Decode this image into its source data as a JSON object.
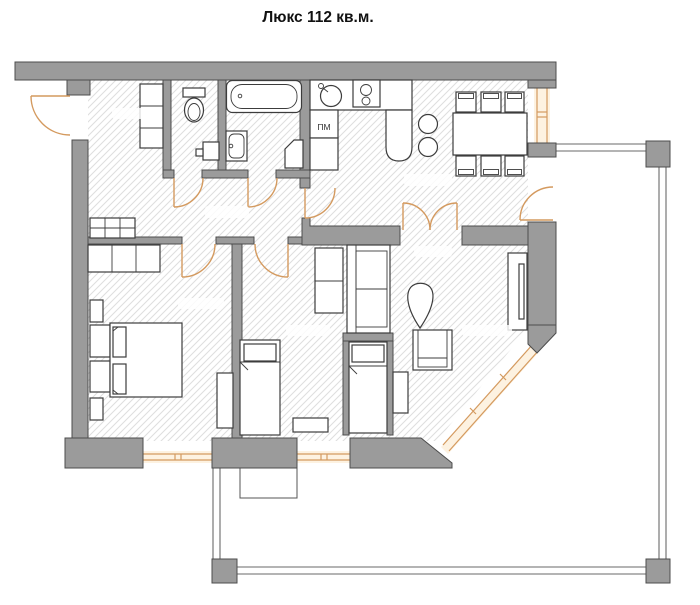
{
  "title": "Люкс 112 кв.м.",
  "plan": {
    "type": "floor-plan",
    "labels": {
      "dishwasher": "ПМ"
    },
    "colors": {
      "wall": "#9b9b9b",
      "wall_outline": "#4c4c4c",
      "accent": "#d49a5f",
      "hatch": "#dedede",
      "furniture_outline": "#3c3c3c",
      "terrace": "#6a6a6a",
      "title_text": "#111111"
    },
    "fixtures": [
      "entrance-door",
      "toilet",
      "wc-sink",
      "bathtub",
      "washbasin",
      "corner-unit",
      "kitchen-sink",
      "cooktop",
      "dishwasher-cabinet",
      "bar-counter",
      "bar-stool",
      "dining-table",
      "dining-chair",
      "shoe-cabinet",
      "hall-shelves",
      "wardrobe",
      "double-bed",
      "nightstand",
      "single-bed",
      "desk",
      "dresser",
      "sofa",
      "armchair",
      "plant",
      "tv-unit",
      "console",
      "french-doors",
      "window",
      "terrace-railing",
      "terrace-pillar",
      "planter"
    ]
  }
}
